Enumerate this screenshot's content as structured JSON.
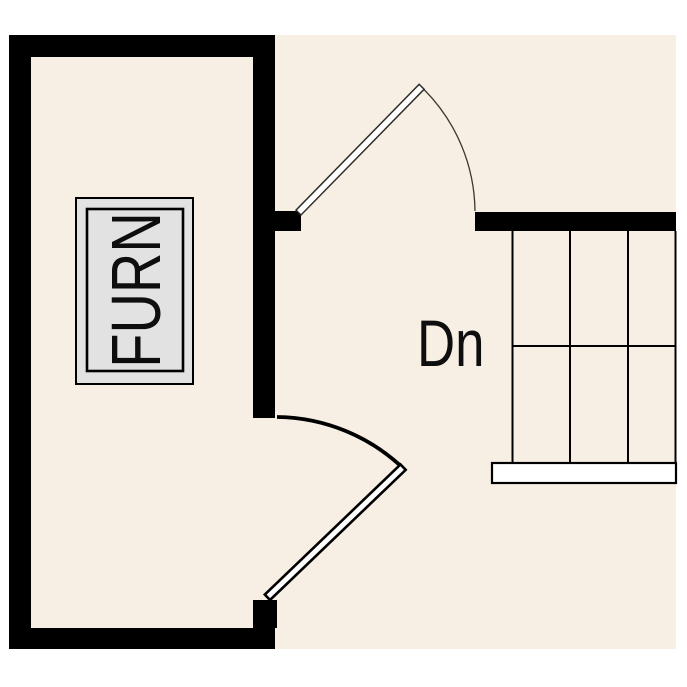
{
  "plan": {
    "labels": {
      "furnace": "FURN",
      "stairs_down": "Dn"
    },
    "colors": {
      "page": "#ffffff",
      "floor": "#f7efe3",
      "wall": "#000000",
      "furnace_fill": "#e2e2e2",
      "furnace_outline": "#000000",
      "door_leaf": "#ffffff",
      "door_leaf_top_stroke": "#2e2c28",
      "door_arc_top_stroke": "#3a3832",
      "door_bottom_stroke": "#000000",
      "stair_line": "#000000",
      "landing_fill": "#ffffff",
      "text": "#0e0e0e"
    }
  }
}
